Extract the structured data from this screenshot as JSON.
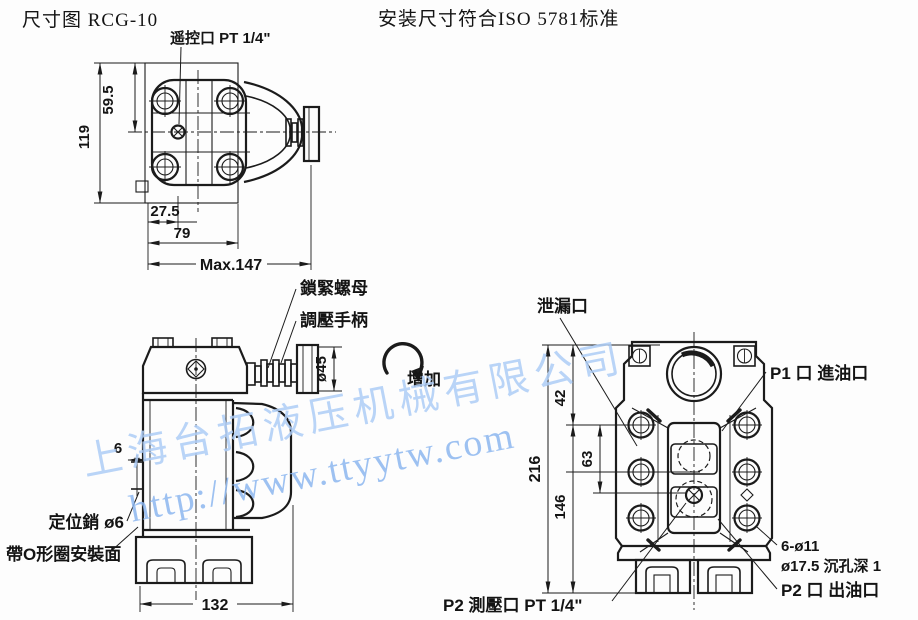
{
  "header": {
    "title": "尺寸图 RCG-10",
    "standard_note": "安装尺寸符合ISO 5781标准"
  },
  "colors": {
    "ink": "#1b1b1b",
    "background": "#fdfdfd",
    "watermark_company": "#aecdf6",
    "watermark_url": "#8db7f0"
  },
  "top_view": {
    "remote_port_label": "遥控口 PT 1/4\"",
    "dims": {
      "half_height": "59.5",
      "height": "119",
      "port_offset": "27.5",
      "body_width": "79",
      "max_length": "Max.147"
    }
  },
  "side_view": {
    "lock_nut_label": "鎖緊螺母",
    "handle_label": "調壓手柄",
    "increase_label": "增加",
    "pin_label": "定位銷 ø6",
    "oring_label": "帶O形圈安裝面",
    "dims": {
      "handle_dia": "ø45",
      "pin_dia": "6",
      "base_width": "132"
    }
  },
  "front_view": {
    "leak_port_label": "泄漏口",
    "p1_label": "P1 口 進油口",
    "bolt_holes_label": "6-ø11",
    "counterbore_label": "ø17.5 沉孔深 1",
    "p2_out_label": "P2 口 出油口",
    "p2_gauge_label": "P2 測壓口 PT 1/4\"",
    "dims": {
      "total_height": "216",
      "lower_height": "146",
      "bolt_spacing": "63",
      "top_offset": "42"
    }
  },
  "watermark": {
    "company": "上海台拓液压机械有限公司",
    "url": "http://www.ttyytw.com"
  }
}
